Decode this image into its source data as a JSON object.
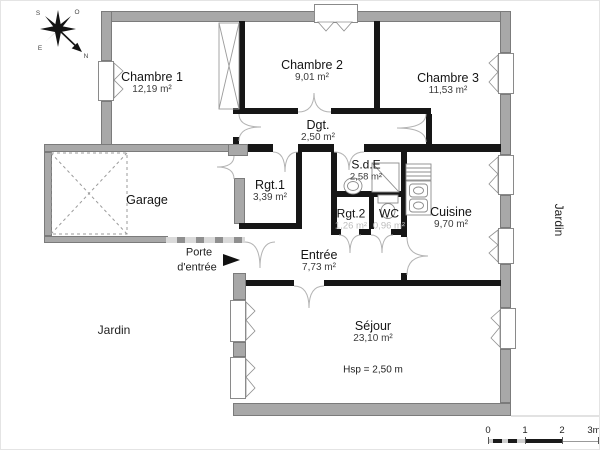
{
  "compass": {
    "north": "N",
    "south": "S",
    "east": "E",
    "west": "O"
  },
  "rooms": {
    "chambre1": {
      "name": "Chambre 1",
      "area": "12,19 m²"
    },
    "chambre2": {
      "name": "Chambre 2",
      "area": "9,01 m²"
    },
    "chambre3": {
      "name": "Chambre 3",
      "area": "11,53 m²"
    },
    "dgt": {
      "name": "Dgt.",
      "area": "2,50 m²"
    },
    "garage": {
      "name": "Garage"
    },
    "rgt1": {
      "name": "Rgt.1",
      "area": "3,39 m²"
    },
    "sde": {
      "name": "S.d.E",
      "area": "2,58 m²"
    },
    "rgt2": {
      "name": "Rgt.2",
      "area": "1,26 m²"
    },
    "wc": {
      "name": "WC",
      "area": "0,96 m²"
    },
    "cuisine": {
      "name": "Cuisine",
      "area": "9,70 m²"
    },
    "entree": {
      "name": "Entrée",
      "area": "7,73 m²"
    },
    "sejour": {
      "name": "Séjour",
      "area": "23,10 m²"
    }
  },
  "annotations": {
    "ceiling_height": "Hsp = 2,50 m",
    "entry_door_line1": "Porte",
    "entry_door_line2": "d'entrée",
    "garden_bottom": "Jardin",
    "garden_right": "Jardin"
  },
  "scale_bar": {
    "tick0": "0",
    "tick1": "1",
    "tick2": "2",
    "tick3": "3m"
  }
}
